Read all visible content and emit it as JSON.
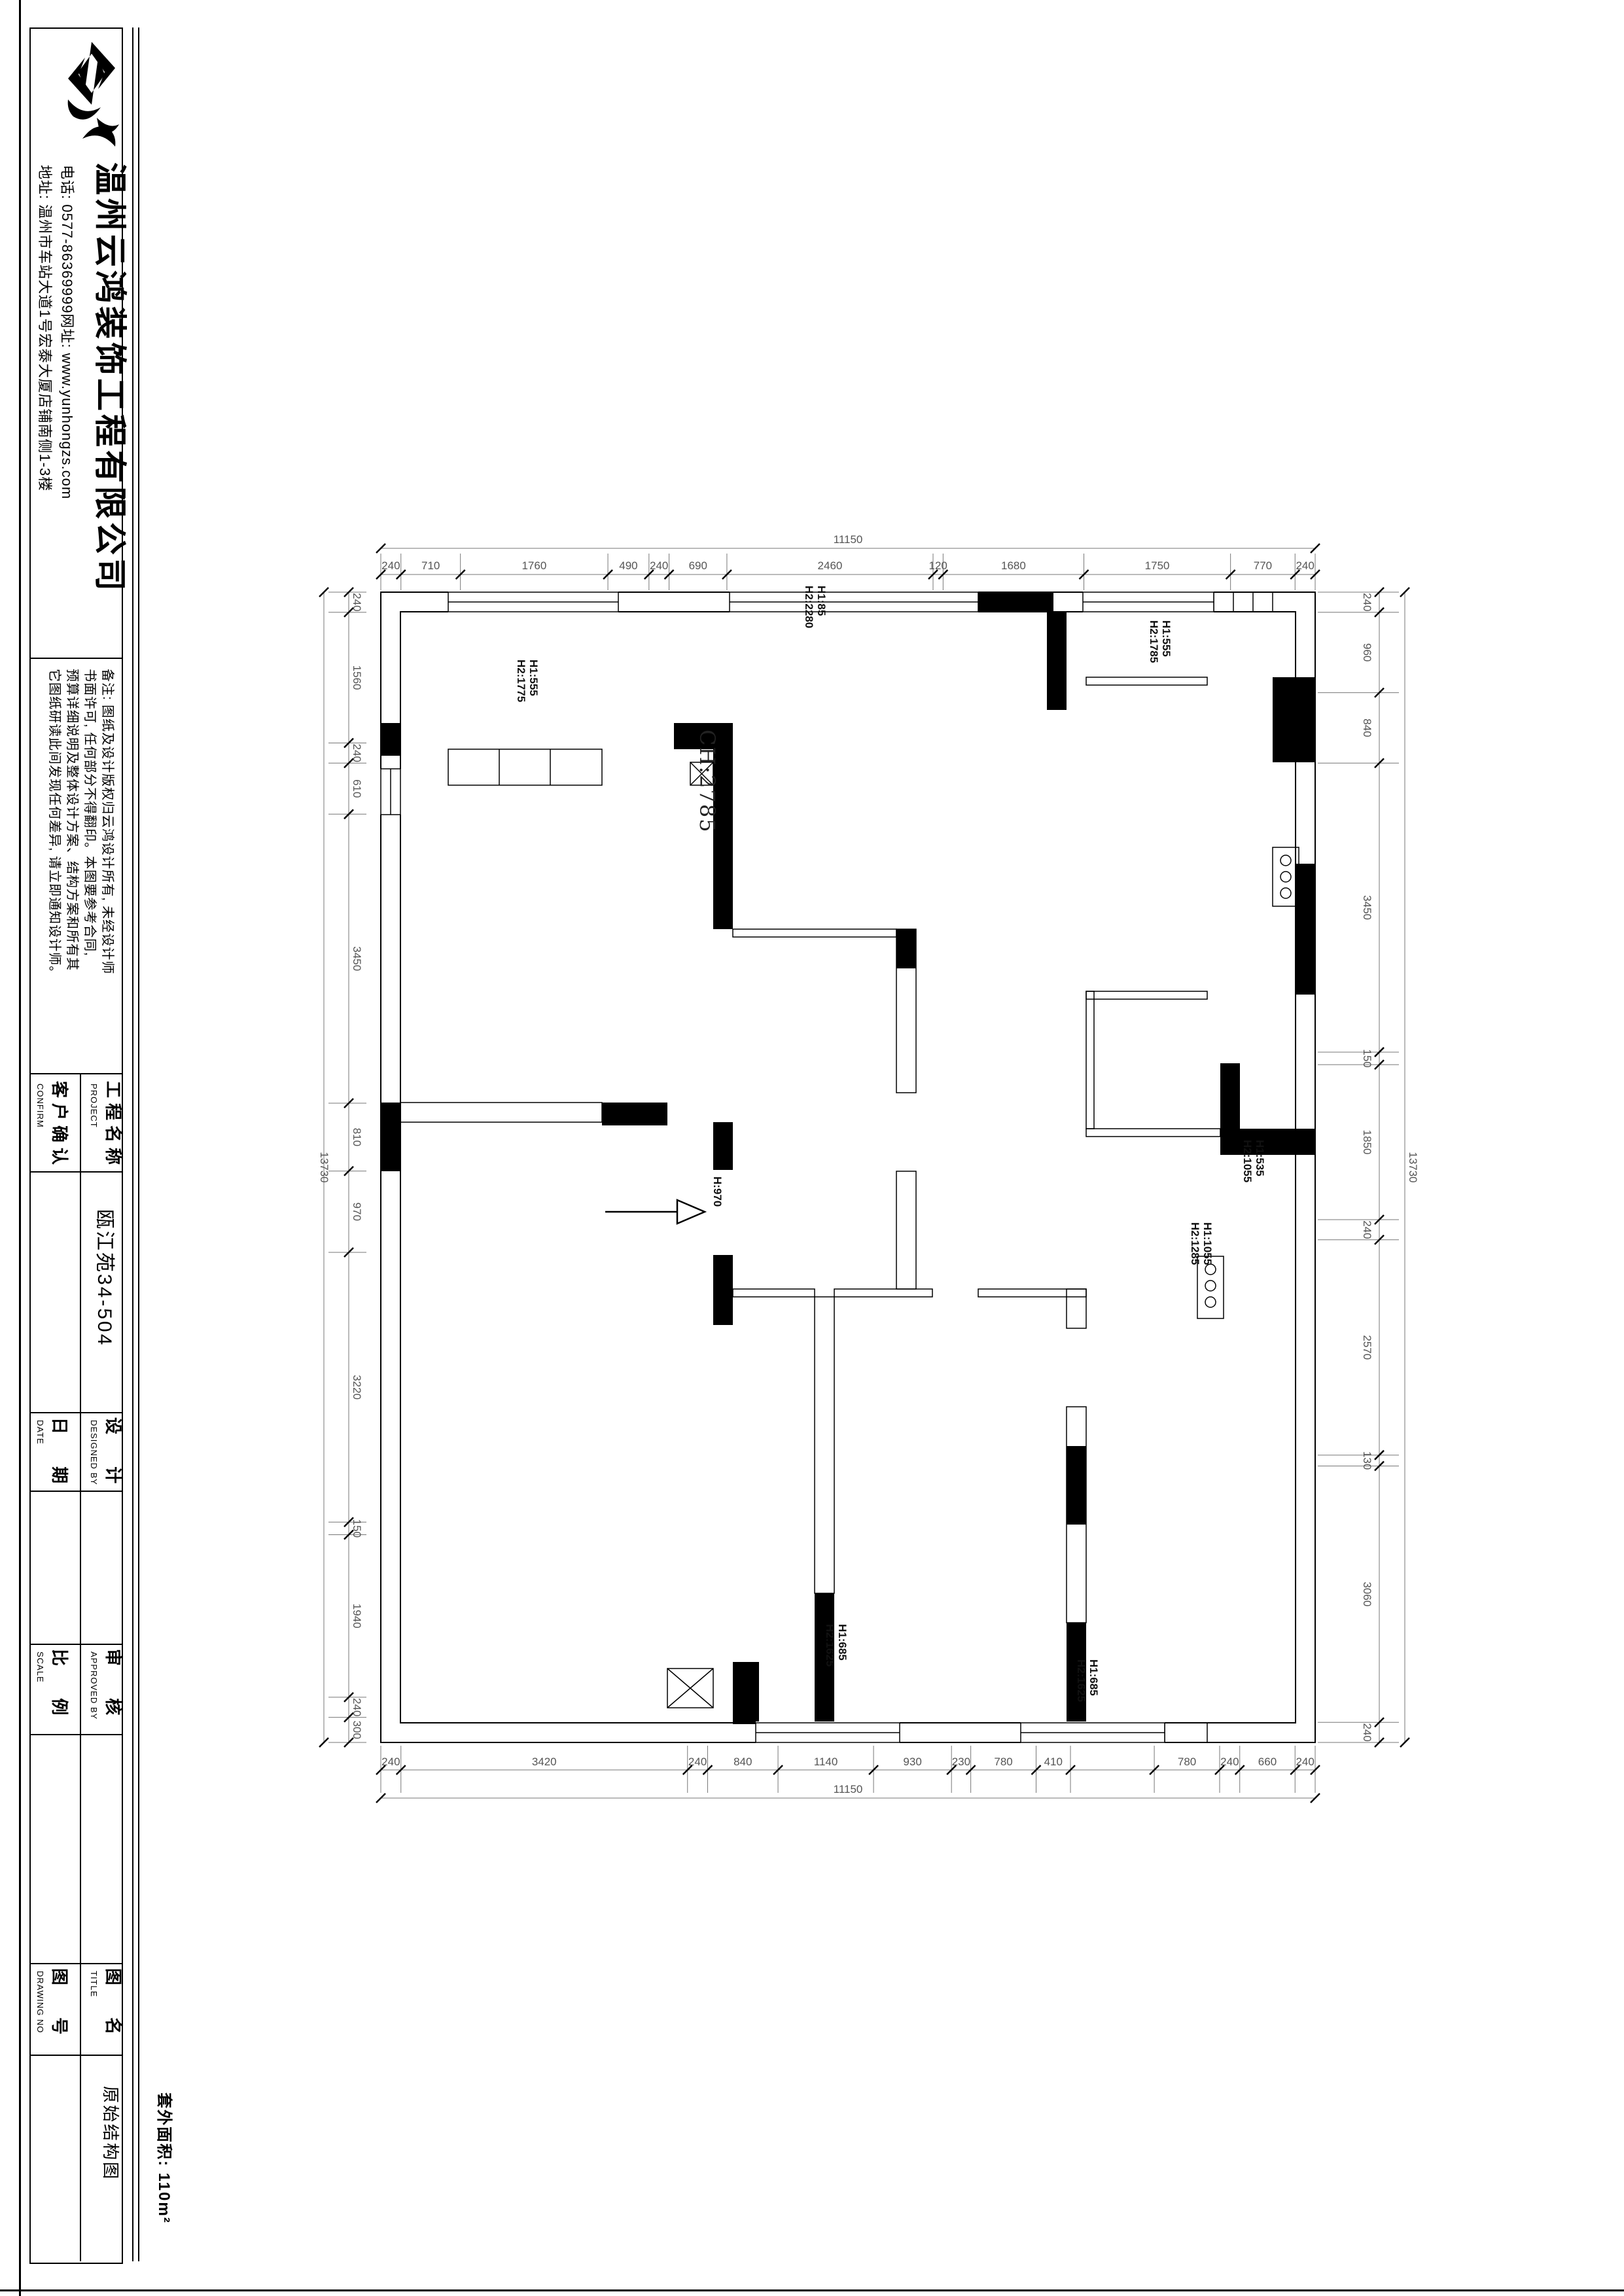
{
  "sheet": {
    "company": {
      "name": "温州云鸿装饰工程有限公司",
      "contact_line1": "电话: 0577-86369999网址: www.yunhongzs.com",
      "contact_line2": "地址: 温州市车站大道1号宏泰大厦店铺南侧1-3楼"
    },
    "notes": {
      "line1": "备注: 图纸及设计版权归云鸿设计所有, 未经设计师",
      "line2": "书面许可, 任何部分不得翻印。本图要参考合同,",
      "line3": "预算详细说明及整体设计方案、结构方案和所有其",
      "line4": "它图纸研读此间发现任何差异, 请立即通知设计师。"
    },
    "title_block": {
      "project_label": "工程名称",
      "project_label_en": "PROJECT",
      "confirm_label": "客户确认",
      "confirm_label_en": "CONFIRM",
      "project_value": "瓯江苑34-504",
      "designed_label": "设 计",
      "designed_label_en": "DESIGNED BY",
      "date_label": "日 期",
      "date_label_en": "DATE",
      "approved_label": "审 核",
      "approved_label_en": "APPROVED BY",
      "scale_label": "比 例",
      "scale_label_en": "SCALE",
      "title_label": "图 名",
      "title_label_en": "TITLE",
      "drawing_no_label": "图 号",
      "drawing_no_label_en": "DRAWING NO",
      "drawing_title_value": "原始结构图"
    },
    "area_note": "套外面积: 110m²"
  },
  "plan": {
    "ceiling_label": "CH:2785",
    "door_label": "H:970",
    "opening_labels": [
      {
        "id": "top_center",
        "line1": "H1:85",
        "line2": "H2:2280"
      },
      {
        "id": "top_right",
        "line1": "H1:555",
        "line2": "H2:1785"
      },
      {
        "id": "left_window",
        "line1": "H1:555",
        "line2": "H2:1775"
      },
      {
        "id": "right_upper",
        "line1": "H1:535",
        "line2": "H2:1055"
      },
      {
        "id": "right_lower",
        "line1": "H1:1055",
        "line2": "H2:1285"
      },
      {
        "id": "bottom_left",
        "line1": "H1:685",
        "line2": "H2:1625"
      },
      {
        "id": "bottom_right",
        "line1": "H1:685",
        "line2": "H2:1625"
      }
    ],
    "dims": {
      "top": {
        "total": "11150",
        "segments": [
          "240",
          "710",
          "1760",
          "490",
          "240",
          "690",
          "2460",
          "120",
          "1680",
          "1750",
          "770",
          "240"
        ]
      },
      "bottom": {
        "total": "11150",
        "segments": [
          "240",
          "3420",
          "240",
          "840",
          "1140",
          "930",
          "230",
          "780",
          "410",
          "",
          "780",
          "240",
          "660",
          "240"
        ]
      },
      "left": {
        "total": "13730",
        "segments": [
          "240",
          "1560",
          "240",
          "610",
          "3450",
          "810",
          "970",
          "3220",
          "150",
          "1940",
          "240",
          "300"
        ]
      },
      "right": {
        "total": "13730",
        "segments": [
          "240",
          "960",
          "840",
          "3450",
          "150",
          "1850",
          "240",
          "2570",
          "130",
          "3060",
          "240"
        ]
      }
    }
  }
}
